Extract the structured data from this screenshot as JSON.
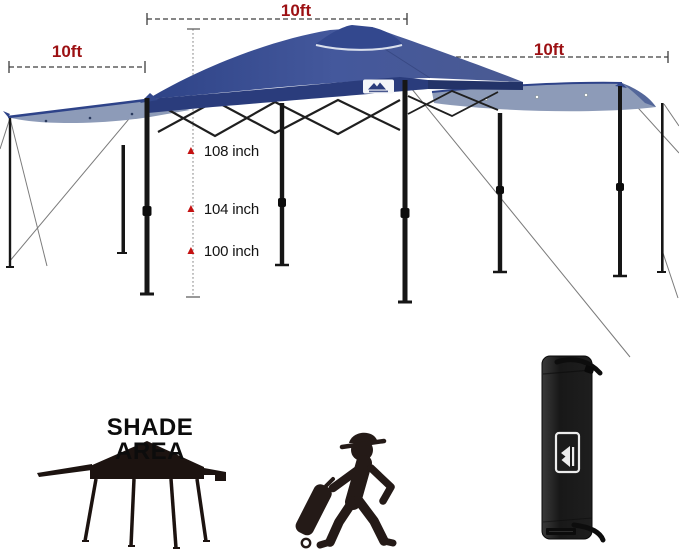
{
  "annotations": {
    "width_left": "10ft",
    "width_top": "10ft",
    "width_right": "10ft",
    "heights": [
      {
        "marker": "▲",
        "value": "108 inch"
      },
      {
        "marker": "▲",
        "value": "104 inch"
      },
      {
        "marker": "▲",
        "value": "100 inch"
      }
    ]
  },
  "shade_area": {
    "label": "SHADE AREA"
  },
  "icons": {
    "height_marker": "red-triangle-up",
    "canopy_logo": "mountain-logo",
    "bag_logo": "mountain-logo",
    "shade_tent": "canopy-silhouette",
    "person": "person-pulling-wheeled-bag",
    "carry_bag": "canopy-carry-bag"
  },
  "colors": {
    "dimension_label": "#9c1013",
    "height_marker": "#c41111",
    "canopy_blue": "#3f5396",
    "canopy_valance": "#2a3c7c",
    "awning_blue": "#8d9bb8",
    "silhouette_black": "#241a17",
    "bag_black": "#1b1b1b"
  }
}
